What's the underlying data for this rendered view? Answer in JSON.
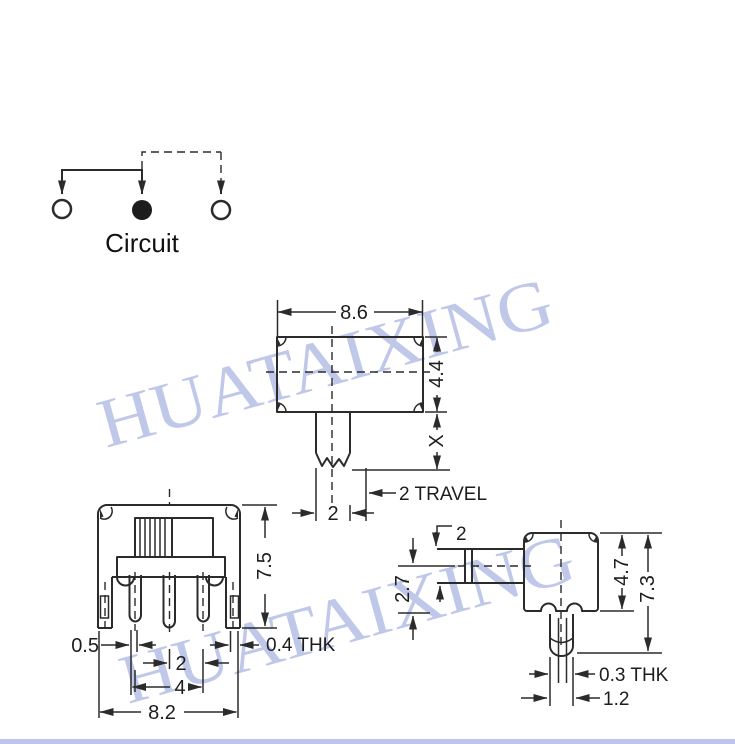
{
  "watermark": {
    "text": "HUATAIXING"
  },
  "circuit": {
    "label": "Circuit"
  },
  "top_view": {
    "body_width": "8.6",
    "body_depth": "4.4",
    "shaft_height": "X",
    "travel": "2 TRAVEL",
    "shaft_width": "2"
  },
  "front_view": {
    "overall_height": "7.5",
    "terminal_width": "0.5",
    "terminal_pitch": "2",
    "terminal_span": "4",
    "overall_width": "8.2",
    "bracket_thickness": "0.4 THK"
  },
  "side_view": {
    "actuator_thickness": "2",
    "actuator_center_height": "2.7",
    "body_height": "4.7",
    "overall_height": "7.3",
    "terminal_thickness": "0.3 THK",
    "terminal_width": "1.2"
  },
  "colors": {
    "line": "#2b2b2b",
    "watermark": "#9aa8de",
    "bottom_bar": "#bcc6ec"
  }
}
